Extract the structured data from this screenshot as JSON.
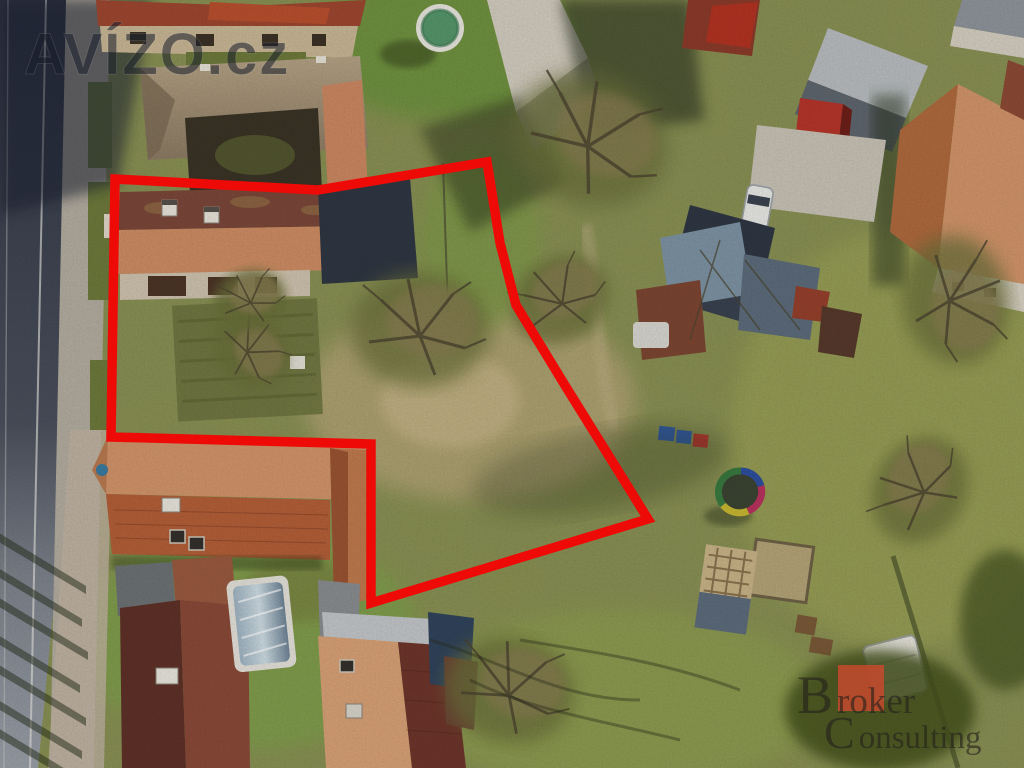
{
  "image": {
    "title": "Aerial drone photo of a village building plot outlined in red",
    "width_px": 1024,
    "height_px": 768
  },
  "watermark": {
    "text": "AVÍZO.cz",
    "color": "rgba(24,29,41,0.55)"
  },
  "parcel_outline": {
    "color": "#ee0b07",
    "stroke_width": 9.5,
    "points": "115,179 318,190 487,162 500,243 516,305 566,387 648,519 371,603 371,444 111,437"
  },
  "brand_logo": {
    "line1_initial": "B",
    "line1_rest": "roker",
    "line2_initial": "C",
    "line2_rest": "onsulting",
    "square_color": "#c14a2c",
    "text_color": "rgba(35,32,28,0.62)"
  },
  "scene": {
    "palette": {
      "grass_base": "#8a9150",
      "grass_bright": "#6f9240",
      "grass_dark": "#5c6b35",
      "scrub_tan": "#b3a474",
      "dirt_light": "#c3b286",
      "road_asphalt": "#3a4150",
      "road_light": "#8a8f97",
      "sidewalk": "#b4ada0",
      "roof_weathered": "#a8977c",
      "roof_salmon": "#ce8d64",
      "roof_brick_dark": "#7b4739",
      "roof_orange": "#b45f38",
      "roof_orange_light": "#d2956a",
      "roof_dark_navy": "#2f3743",
      "roof_gray": "#aab0b4",
      "roof_rust": "#8a4631",
      "roof_red_shed": "#b6352a",
      "metal_blue": "#7d93a4",
      "pool_green": "#55966b",
      "tree_olive": "#6b6f3b",
      "tree_dark": "#3f4827"
    }
  }
}
